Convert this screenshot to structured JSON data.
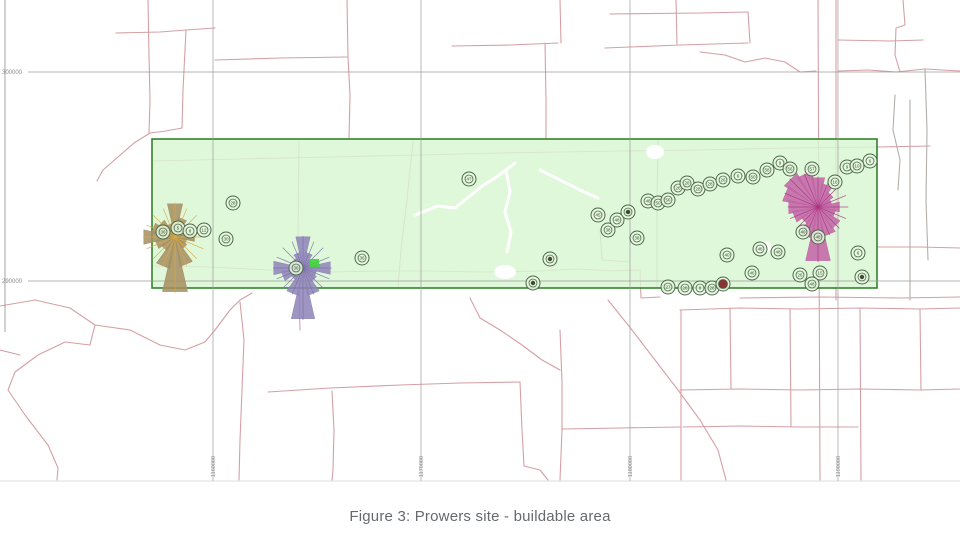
{
  "caption": "Figure 3: Prowers site - buildable area",
  "colors": {
    "road": "#d4a0a4",
    "road_grey": "#b3aeaa",
    "grid": "#9b9b9b",
    "axis_label": "#8a8a8a",
    "map_edge": "#dcdcdc",
    "area_fill": "#d9f6d2",
    "area_border": "#35802e",
    "marker_ring": "#4c664c",
    "marker_fill": "#e6f8de",
    "marker_text": "#2c522c",
    "marker_dark": "#3f4a38",
    "marker_red": "#8a3434",
    "water": "#ffffff",
    "green_square": "#3fd23c",
    "caption_color": "#666a6e"
  },
  "axes": {
    "y_ticks": [
      {
        "label": "300000",
        "y": 72
      },
      {
        "label": "290000",
        "y": 281
      }
    ],
    "x_ticks": [
      {
        "label": "1160000",
        "x": 213
      },
      {
        "label": "1170000",
        "x": 421
      },
      {
        "label": "1180000",
        "x": 630
      },
      {
        "label": "1190000",
        "x": 838
      }
    ]
  },
  "buildable_area": {
    "x": 152,
    "y": 139,
    "width": 725,
    "height": 149
  },
  "green_square": {
    "x": 309,
    "y": 259,
    "w": 10,
    "h": 8
  },
  "wind_roses": [
    {
      "name": "wind-rose-west",
      "cx": 175,
      "cy": 237,
      "fill": "#a58e60",
      "spoke": "#d9a83e",
      "radii": [
        34,
        20,
        12,
        10,
        20,
        12,
        14,
        30,
        56,
        32,
        16,
        20,
        32,
        24,
        20,
        14
      ]
    },
    {
      "name": "wind-rose-center",
      "cx": 303,
      "cy": 268,
      "fill": "#8e83b8",
      "spoke": "#7a6fa8",
      "radii": [
        32,
        16,
        10,
        8,
        28,
        14,
        16,
        28,
        52,
        28,
        14,
        22,
        30,
        12,
        12,
        16
      ]
    },
    {
      "name": "wind-rose-east",
      "cx": 818,
      "cy": 207,
      "fill": "#c263a6",
      "spoke": "#a8337f",
      "radii": [
        30,
        24,
        18,
        14,
        22,
        18,
        26,
        30,
        55,
        32,
        20,
        26,
        30,
        36,
        40,
        36
      ]
    }
  ],
  "markers": [
    [
      233,
      203,
      "28",
      "n"
    ],
    [
      163,
      232,
      "36",
      "n"
    ],
    [
      178,
      228,
      "5",
      "n"
    ],
    [
      190,
      231,
      "8",
      "n"
    ],
    [
      204,
      230,
      "12",
      "n"
    ],
    [
      226,
      239,
      "30",
      "n"
    ],
    [
      296,
      268,
      "36",
      "n"
    ],
    [
      362,
      258,
      "36",
      "n"
    ],
    [
      469,
      179,
      "47",
      "n"
    ],
    [
      550,
      259,
      "",
      "d"
    ],
    [
      533,
      283,
      "",
      "d"
    ],
    [
      598,
      215,
      "45",
      "n"
    ],
    [
      608,
      230,
      "38",
      "n"
    ],
    [
      617,
      220,
      "48",
      "n"
    ],
    [
      628,
      212,
      "46",
      "d"
    ],
    [
      637,
      238,
      "38",
      "n"
    ],
    [
      648,
      201,
      "48",
      "n"
    ],
    [
      658,
      203,
      "50",
      "n"
    ],
    [
      668,
      200,
      "56",
      "n"
    ],
    [
      678,
      188,
      "26",
      "n"
    ],
    [
      687,
      183,
      "28",
      "n"
    ],
    [
      698,
      189,
      "28",
      "n"
    ],
    [
      710,
      184,
      "28",
      "n"
    ],
    [
      723,
      180,
      "26",
      "n"
    ],
    [
      738,
      176,
      "6",
      "n"
    ],
    [
      753,
      177,
      "60",
      "n"
    ],
    [
      767,
      170,
      "58",
      "n"
    ],
    [
      780,
      163,
      "9",
      "n"
    ],
    [
      790,
      169,
      "56",
      "n"
    ],
    [
      812,
      169,
      "57",
      "n"
    ],
    [
      835,
      182,
      "16",
      "n"
    ],
    [
      847,
      167,
      "9",
      "n"
    ],
    [
      857,
      166,
      "10",
      "n"
    ],
    [
      870,
      161,
      "6",
      "n"
    ],
    [
      727,
      255,
      "40",
      "n"
    ],
    [
      760,
      249,
      "48",
      "n"
    ],
    [
      778,
      252,
      "48",
      "n"
    ],
    [
      752,
      273,
      "46",
      "n"
    ],
    [
      803,
      232,
      "40",
      "n"
    ],
    [
      818,
      237,
      "48",
      "n"
    ],
    [
      668,
      287,
      "27",
      "n"
    ],
    [
      685,
      288,
      "28",
      "n"
    ],
    [
      700,
      288,
      "8",
      "n"
    ],
    [
      712,
      288,
      "28",
      "n"
    ],
    [
      723,
      284,
      "",
      "r"
    ],
    [
      800,
      275,
      "26",
      "n"
    ],
    [
      820,
      273,
      "15",
      "n"
    ],
    [
      812,
      284,
      "48",
      "n"
    ],
    [
      862,
      277,
      "8",
      "d"
    ],
    [
      858,
      253,
      "6",
      "n"
    ]
  ],
  "roads": [
    {
      "pts": [
        [
          148,
          0
        ],
        [
          149,
          55
        ],
        [
          150,
          100
        ],
        [
          149,
          133
        ]
      ]
    },
    {
      "pts": [
        [
          186,
          30
        ],
        [
          183,
          90
        ],
        [
          182,
          128
        ]
      ]
    },
    {
      "pts": [
        [
          116,
          33
        ],
        [
          160,
          32
        ],
        [
          186,
          30
        ],
        [
          215,
          28
        ]
      ]
    },
    {
      "pts": [
        [
          182,
          128
        ],
        [
          166,
          131
        ],
        [
          150,
          133
        ]
      ]
    },
    {
      "pts": [
        [
          150,
          133
        ],
        [
          134,
          143
        ],
        [
          118,
          157
        ],
        [
          103,
          170
        ],
        [
          97,
          181
        ]
      ]
    },
    {
      "pts": [
        [
          215,
          60
        ],
        [
          280,
          58
        ],
        [
          347,
          57
        ]
      ]
    },
    {
      "pts": [
        [
          347,
          0
        ],
        [
          348,
          57
        ]
      ]
    },
    {
      "pts": [
        [
          348,
          57
        ],
        [
          350,
          95
        ],
        [
          349,
          139
        ]
      ]
    },
    {
      "pts": [
        [
          452,
          46
        ],
        [
          510,
          45
        ],
        [
          558,
          43
        ]
      ]
    },
    {
      "pts": [
        [
          545,
          43
        ],
        [
          546,
          100
        ],
        [
          546,
          139
        ]
      ]
    },
    {
      "pts": [
        [
          560,
          0
        ],
        [
          561,
          43
        ]
      ]
    },
    {
      "pts": [
        [
          610,
          14
        ],
        [
          700,
          13
        ],
        [
          748,
          12
        ]
      ]
    },
    {
      "pts": [
        [
          748,
          12
        ],
        [
          750,
          43
        ]
      ]
    },
    {
      "pts": [
        [
          676,
          0
        ],
        [
          677,
          44
        ]
      ]
    },
    {
      "pts": [
        [
          605,
          48
        ],
        [
          680,
          45
        ],
        [
          748,
          43
        ]
      ]
    },
    {
      "pts": [
        [
          838,
          40
        ],
        [
          890,
          41
        ],
        [
          923,
          40
        ]
      ]
    },
    {
      "pts": [
        [
          903,
          0
        ],
        [
          905,
          25
        ],
        [
          896,
          28
        ],
        [
          895,
          55
        ],
        [
          900,
          72
        ]
      ]
    },
    {
      "pts": [
        [
          700,
          52
        ],
        [
          725,
          55
        ],
        [
          745,
          62
        ],
        [
          765,
          58
        ],
        [
          785,
          62
        ],
        [
          800,
          72
        ],
        [
          816,
          71
        ]
      ]
    },
    {
      "pts": [
        [
          838,
          71
        ],
        [
          868,
          70
        ],
        [
          896,
          72
        ],
        [
          925,
          69
        ],
        [
          960,
          71
        ]
      ]
    },
    {
      "pts": [
        [
          895,
          95
        ],
        [
          893,
          130
        ],
        [
          900,
          160
        ],
        [
          898,
          190
        ]
      ],
      "grey": true
    },
    {
      "pts": [
        [
          925,
          69
        ],
        [
          927,
          130
        ],
        [
          926,
          200
        ],
        [
          928,
          260
        ]
      ],
      "grey": true
    },
    {
      "pts": [
        [
          818,
          0
        ],
        [
          819,
          240
        ],
        [
          820,
          480
        ]
      ]
    },
    {
      "pts": [
        [
          836,
          0
        ],
        [
          836,
          300
        ]
      ]
    },
    {
      "pts": [
        [
          0,
          306
        ],
        [
          35,
          300
        ],
        [
          70,
          308
        ],
        [
          95,
          325
        ],
        [
          90,
          345
        ],
        [
          65,
          342
        ],
        [
          38,
          355
        ],
        [
          15,
          372
        ],
        [
          8,
          390
        ],
        [
          25,
          415
        ],
        [
          48,
          445
        ],
        [
          58,
          468
        ],
        [
          57,
          480
        ]
      ]
    },
    {
      "pts": [
        [
          95,
          325
        ],
        [
          130,
          330
        ],
        [
          160,
          345
        ],
        [
          185,
          350
        ],
        [
          205,
          342
        ],
        [
          215,
          330
        ]
      ]
    },
    {
      "pts": [
        [
          215,
          330
        ],
        [
          230,
          310
        ],
        [
          240,
          300
        ],
        [
          252,
          293
        ]
      ]
    },
    {
      "pts": [
        [
          240,
          302
        ],
        [
          244,
          340
        ],
        [
          242,
          390
        ],
        [
          240,
          440
        ],
        [
          239,
          480
        ]
      ]
    },
    {
      "pts": [
        [
          268,
          392
        ],
        [
          330,
          388
        ],
        [
          400,
          385
        ],
        [
          460,
          383
        ],
        [
          520,
          382
        ]
      ]
    },
    {
      "pts": [
        [
          332,
          391
        ],
        [
          334,
          430
        ],
        [
          333,
          470
        ],
        [
          332,
          480
        ]
      ]
    },
    {
      "pts": [
        [
          520,
          382
        ],
        [
          522,
          430
        ],
        [
          524,
          466
        ],
        [
          540,
          470
        ],
        [
          548,
          480
        ]
      ]
    },
    {
      "pts": [
        [
          560,
          330
        ],
        [
          562,
          382
        ],
        [
          562,
          430
        ],
        [
          560,
          480
        ]
      ]
    },
    {
      "pts": [
        [
          562,
          429
        ],
        [
          620,
          428
        ],
        [
          680,
          427
        ]
      ]
    },
    {
      "pts": [
        [
          470,
          298
        ],
        [
          480,
          318
        ],
        [
          500,
          330
        ],
        [
          522,
          345
        ],
        [
          542,
          360
        ],
        [
          560,
          370
        ]
      ]
    },
    {
      "pts": [
        [
          608,
          300
        ],
        [
          632,
          330
        ],
        [
          655,
          360
        ],
        [
          678,
          390
        ],
        [
          700,
          420
        ],
        [
          718,
          450
        ],
        [
          726,
          480
        ]
      ]
    },
    {
      "pts": [
        [
          680,
          310
        ],
        [
          740,
          308
        ],
        [
          800,
          309
        ],
        [
          860,
          308
        ],
        [
          920,
          309
        ],
        [
          960,
          308
        ]
      ]
    },
    {
      "pts": [
        [
          680,
          390
        ],
        [
          740,
          389
        ],
        [
          800,
          390
        ],
        [
          860,
          389
        ],
        [
          920,
          390
        ],
        [
          960,
          389
        ]
      ]
    },
    {
      "pts": [
        [
          683,
          427
        ],
        [
          740,
          426
        ],
        [
          800,
          427
        ],
        [
          858,
          427
        ]
      ]
    },
    {
      "pts": [
        [
          730,
          308
        ],
        [
          731,
          389
        ]
      ]
    },
    {
      "pts": [
        [
          790,
          309
        ],
        [
          791,
          427
        ]
      ]
    },
    {
      "pts": [
        [
          860,
          308
        ],
        [
          861,
          480
        ]
      ]
    },
    {
      "pts": [
        [
          920,
          309
        ],
        [
          921,
          390
        ]
      ]
    },
    {
      "pts": [
        [
          681,
          310
        ],
        [
          681,
          480
        ]
      ]
    },
    {
      "pts": [
        [
          740,
          298
        ],
        [
          820,
          297
        ],
        [
          900,
          298
        ],
        [
          960,
          297
        ]
      ]
    },
    {
      "pts": [
        [
          877,
          247
        ],
        [
          920,
          247
        ],
        [
          960,
          248
        ]
      ]
    },
    {
      "pts": [
        [
          152,
          161
        ],
        [
          240,
          159
        ],
        [
          330,
          157
        ],
        [
          420,
          155
        ],
        [
          500,
          153
        ],
        [
          560,
          152
        ],
        [
          620,
          151
        ],
        [
          700,
          150
        ],
        [
          790,
          148
        ],
        [
          877,
          147
        ]
      ]
    },
    {
      "pts": [
        [
          152,
          266
        ],
        [
          210,
          267
        ],
        [
          270,
          270
        ],
        [
          330,
          272
        ],
        [
          380,
          271
        ],
        [
          430,
          271
        ],
        [
          480,
          272
        ],
        [
          540,
          271
        ],
        [
          578,
          269
        ],
        [
          612,
          271
        ],
        [
          640,
          270
        ]
      ]
    },
    {
      "pts": [
        [
          299,
          139
        ],
        [
          298,
          240
        ],
        [
          299,
          290
        ],
        [
          300,
          330
        ]
      ]
    },
    {
      "pts": [
        [
          658,
          139
        ],
        [
          657,
          200
        ],
        [
          657,
          250
        ],
        [
          657,
          288
        ]
      ],
      "grey": true
    },
    {
      "pts": [
        [
          413,
          141
        ],
        [
          407,
          200
        ],
        [
          401,
          250
        ],
        [
          398,
          287
        ]
      ]
    },
    {
      "pts": [
        [
          600,
          230
        ],
        [
          602,
          260
        ],
        [
          630,
          262
        ]
      ]
    },
    {
      "pts": [
        [
          640,
          270
        ],
        [
          641,
          298
        ],
        [
          660,
          297
        ]
      ]
    },
    {
      "pts": [
        [
          877,
          147
        ],
        [
          930,
          146
        ]
      ]
    },
    {
      "pts": [
        [
          910,
          100
        ],
        [
          910,
          300
        ]
      ],
      "grey": true
    },
    {
      "pts": [
        [
          0,
          350
        ],
        [
          20,
          355
        ]
      ]
    }
  ],
  "water": {
    "paths": [
      [
        [
          415,
          215
        ],
        [
          438,
          206
        ],
        [
          455,
          208
        ],
        [
          470,
          196
        ],
        [
          482,
          186
        ],
        [
          495,
          178
        ],
        [
          506,
          170
        ],
        [
          515,
          163
        ]
      ],
      [
        [
          506,
          170
        ],
        [
          510,
          192
        ],
        [
          505,
          212
        ],
        [
          511,
          232
        ],
        [
          507,
          252
        ]
      ],
      [
        [
          540,
          170
        ],
        [
          560,
          180
        ],
        [
          580,
          190
        ],
        [
          598,
          198
        ]
      ]
    ],
    "ellipses": [
      [
        655,
        152,
        9,
        7
      ],
      [
        505,
        272,
        11,
        7
      ],
      [
        763,
        247,
        8,
        6
      ]
    ]
  },
  "layout": {
    "map_width": 960,
    "map_height": 483,
    "left_axis_x": 5,
    "left_axis_y2": 332,
    "bottom_edge_y": 481
  }
}
